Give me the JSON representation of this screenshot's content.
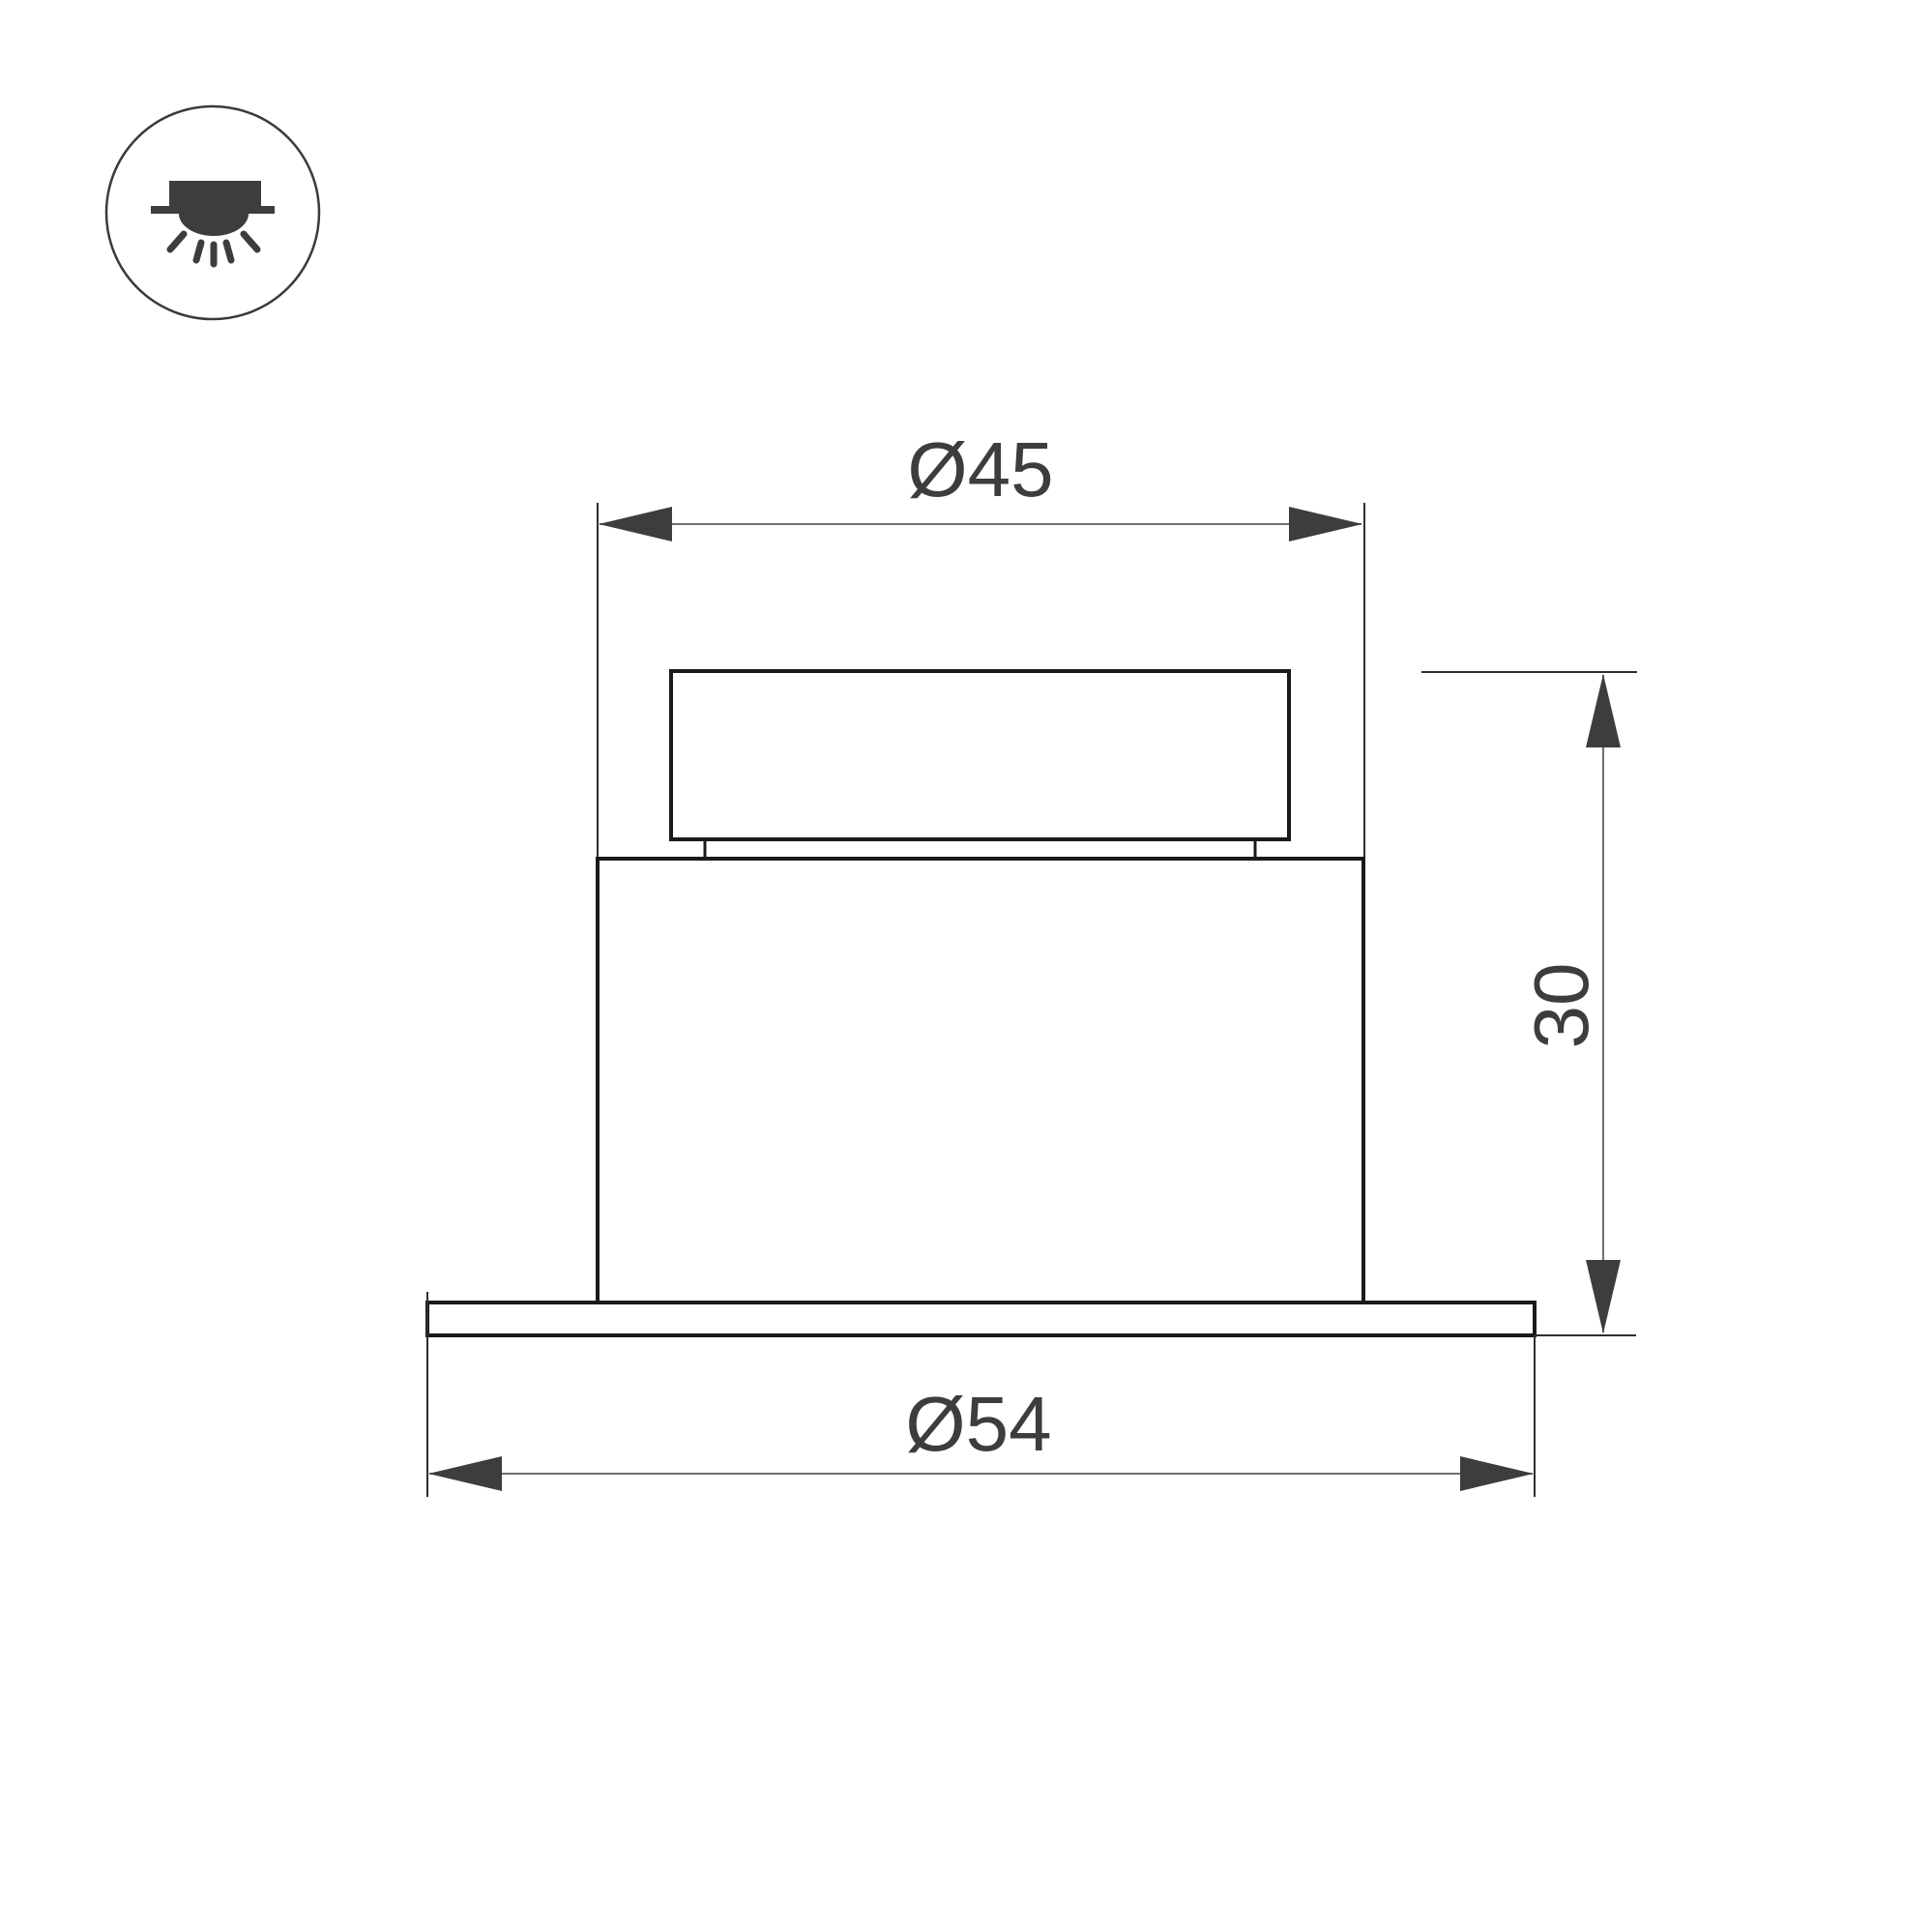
{
  "drawing": {
    "kind": "technical-dimension-drawing",
    "dimensions": {
      "top_diameter": {
        "label": "Ø45",
        "value": 45
      },
      "bottom_diameter": {
        "label": "Ø54",
        "value": 54
      },
      "height": {
        "label": "30",
        "value": 30
      }
    },
    "icon": {
      "name": "recessed-downlight-icon"
    }
  },
  "colors": {
    "background": "#ffffff",
    "outline": "#1a1a1a",
    "ink": "#3d3d3d",
    "dimension_line": "#707070",
    "extension_line": "#2e2e2e"
  }
}
